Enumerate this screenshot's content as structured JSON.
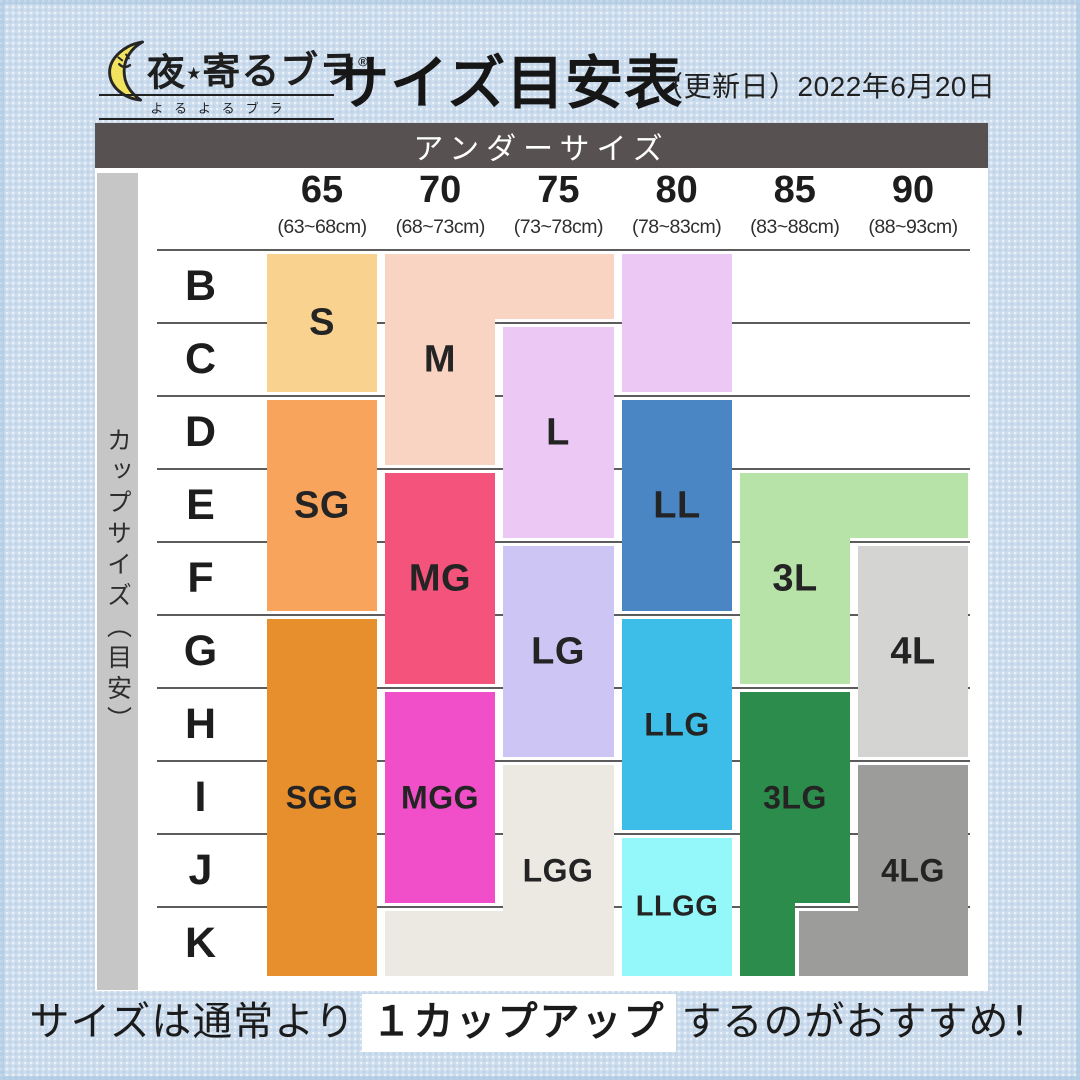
{
  "header": {
    "logo": {
      "name_pre": "夜",
      "star": "★",
      "name_post": "寄るブラ",
      "registered": "®",
      "furigana": "よるよるブラ"
    },
    "title": "サイズ目安表",
    "date_note": "（更新日）2022年6月20日"
  },
  "footer": {
    "pre": "サイズは通常より",
    "highlight": "１カップアップ",
    "post": "するのがおすすめ！"
  },
  "chart_data": {
    "type": "heatmap",
    "title": "サイズ目安表",
    "band_label": "アンダーサイズ",
    "side_label": "カップサイズ（目安）",
    "columns": [
      {
        "size": "65",
        "range": "(63~68cm)"
      },
      {
        "size": "70",
        "range": "(68~73cm)"
      },
      {
        "size": "75",
        "range": "(73~78cm)"
      },
      {
        "size": "80",
        "range": "(78~83cm)"
      },
      {
        "size": "85",
        "range": "(83~88cm)"
      },
      {
        "size": "90",
        "range": "(88~93cm)"
      }
    ],
    "rows": [
      "B",
      "C",
      "D",
      "E",
      "F",
      "G",
      "H",
      "I",
      "J",
      "K"
    ],
    "blocks": [
      {
        "label": "S",
        "color": "#FAD28F",
        "coverage": {
          "65": "B-C"
        },
        "rects": [
          [
            172,
            131,
            110,
            138
          ]
        ],
        "label_pos": [
          227,
          200
        ]
      },
      {
        "label": "M",
        "color": "#FAD4C2",
        "coverage": {
          "70": "B-D",
          "75": "B"
        },
        "rects": [
          [
            290,
            131,
            229,
            65
          ],
          [
            290,
            131,
            110,
            211
          ]
        ],
        "label_pos": [
          345,
          237
        ]
      },
      {
        "label": "L",
        "color": "#ECC9F5",
        "coverage": {
          "80": "B-C",
          "75": "C-E"
        },
        "rects": [
          [
            527,
            131,
            110,
            138
          ],
          [
            408,
            204,
            111,
            211
          ]
        ],
        "label_pos": [
          463,
          310
        ]
      },
      {
        "label": "LL",
        "color": "#4A86C3",
        "coverage": {
          "80": "D-F"
        },
        "rects": [
          [
            527,
            277,
            110,
            211
          ]
        ],
        "label_pos": [
          582,
          383
        ]
      },
      {
        "label": "SG",
        "color": "#F9A45D",
        "coverage": {
          "65": "D-F"
        },
        "rects": [
          [
            172,
            277,
            110,
            211
          ]
        ],
        "label_pos": [
          227,
          383
        ]
      },
      {
        "label": "MG",
        "color": "#F4537B",
        "coverage": {
          "70": "E-G"
        },
        "rects": [
          [
            290,
            350,
            110,
            211
          ]
        ],
        "label_pos": [
          345,
          456
        ]
      },
      {
        "label": "3L",
        "color": "#B7E3A8",
        "coverage": {
          "85": "E-G",
          "90": "E"
        },
        "rects": [
          [
            645,
            350,
            228,
            65
          ],
          [
            645,
            350,
            110,
            211
          ]
        ],
        "label_pos": [
          700,
          456
        ]
      },
      {
        "label": "LG",
        "color": "#CDC5F3",
        "coverage": {
          "75": "F-H"
        },
        "rects": [
          [
            408,
            423,
            111,
            211
          ]
        ],
        "label_pos": [
          463,
          529
        ]
      },
      {
        "label": "4L",
        "color": "#D4D4D3",
        "coverage": {
          "90": "F-H"
        },
        "rects": [
          [
            763,
            423,
            110,
            211
          ]
        ],
        "label_pos": [
          818,
          529
        ]
      },
      {
        "label": "SGG",
        "color": "#E78E2D",
        "coverage": {
          "65": "G-K"
        },
        "rects": [
          [
            172,
            496,
            110,
            357
          ]
        ],
        "label_pos": [
          227,
          675
        ]
      },
      {
        "label": "LLG",
        "color": "#3DBEE8",
        "coverage": {
          "80": "G-I"
        },
        "rects": [
          [
            527,
            496,
            110,
            211
          ]
        ],
        "label_pos": [
          582,
          602
        ]
      },
      {
        "label": "MGG",
        "color": "#F14FC9",
        "coverage": {
          "70": "H-J"
        },
        "rects": [
          [
            290,
            569,
            110,
            211
          ]
        ],
        "label_pos": [
          345,
          675
        ]
      },
      {
        "label": "3LG",
        "color": "#2B8C4B",
        "coverage": {
          "85": "H-K"
        },
        "rects": [
          [
            645,
            569,
            110,
            211
          ],
          [
            645,
            569,
            55,
            284
          ]
        ],
        "label_pos": [
          700,
          675
        ]
      },
      {
        "label": "LGG",
        "color": "#ECE9E3",
        "coverage": {
          "75": "I-K",
          "70": "K"
        },
        "rects": [
          [
            408,
            642,
            111,
            211
          ],
          [
            290,
            788,
            229,
            65
          ]
        ],
        "label_pos": [
          463,
          748
        ]
      },
      {
        "label": "4LG",
        "color": "#9C9C9B",
        "coverage": {
          "90": "I-K",
          "85": "K"
        },
        "rects": [
          [
            763,
            642,
            110,
            211
          ],
          [
            704,
            788,
            169,
            65
          ]
        ],
        "label_pos": [
          818,
          748
        ]
      },
      {
        "label": "LLGG",
        "color": "#94F7FA",
        "coverage": {
          "80": "J-K"
        },
        "rects": [
          [
            527,
            715,
            110,
            138
          ]
        ],
        "label_pos": [
          582,
          784
        ]
      }
    ]
  }
}
